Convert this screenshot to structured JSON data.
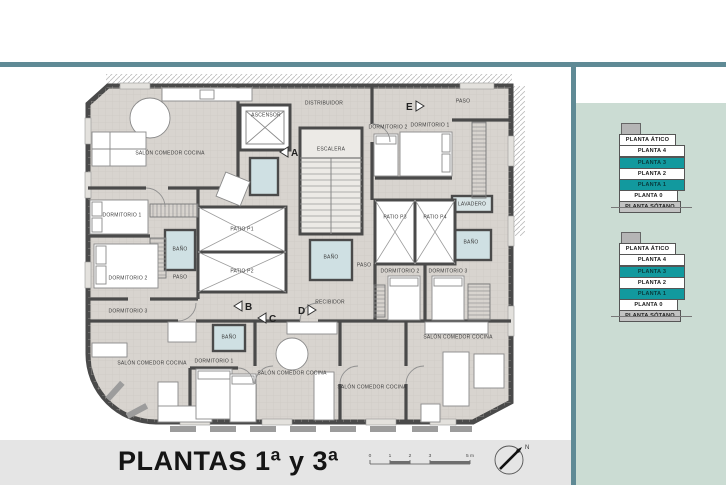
{
  "colors": {
    "frame": "#5f8a95",
    "panel_bg": "#cbdcd3",
    "highlight": "#12999e"
  },
  "title": "PLANTAS 1ª y 3ª",
  "legend": {
    "floors": [
      {
        "label": "PLANTA ÁTICO",
        "state": "plain"
      },
      {
        "label": "PLANTA 4",
        "state": "plain"
      },
      {
        "label": "PLANTA 3",
        "state": "teal"
      },
      {
        "label": "PLANTA 2",
        "state": "plain"
      },
      {
        "label": "PLANTA 1",
        "state": "teal"
      },
      {
        "label": "PLANTA 0",
        "state": "plain"
      },
      {
        "label": "PLANTA SÓTANO",
        "state": "gray"
      }
    ]
  },
  "plan": {
    "rooms": [
      {
        "label": "SALÓN COMEDOR COCINA"
      },
      {
        "label": "ASCENSOR"
      },
      {
        "label": "DISTRIBUIDOR"
      },
      {
        "label": "ESCALERA"
      },
      {
        "label": "PASO"
      },
      {
        "label": "DORMITORIO 1"
      },
      {
        "label": "DORMITORIO 2"
      },
      {
        "label": "LAVADERO"
      },
      {
        "label": "DORMITORIO 1"
      },
      {
        "label": "DORMITORIO 2"
      },
      {
        "label": "DORMITORIO 3"
      },
      {
        "label": "BAÑO"
      },
      {
        "label": "PASO"
      },
      {
        "label": "PATIO P1"
      },
      {
        "label": "PATIO P2"
      },
      {
        "label": "BAÑO"
      },
      {
        "label": "PASO"
      },
      {
        "label": "RECIBIDOR"
      },
      {
        "label": "PATIO P3"
      },
      {
        "label": "PATIO P4"
      },
      {
        "label": "BAÑO"
      },
      {
        "label": "DORMITORIO 2"
      },
      {
        "label": "DORMITORIO 3"
      },
      {
        "label": "SALÓN COMEDOR COCINA"
      },
      {
        "label": "BAÑO"
      },
      {
        "label": "DORMITORIO 1"
      },
      {
        "label": "SALÓN COMEDOR COCINA"
      },
      {
        "label": "SALÓN COMEDOR COCINA"
      },
      {
        "label": "SALÓN COMEDOR COCINA"
      }
    ],
    "section_markers": [
      {
        "letter": "A"
      },
      {
        "letter": "B"
      },
      {
        "letter": "C"
      },
      {
        "letter": "D"
      },
      {
        "letter": "E"
      }
    ]
  },
  "scalebar": {
    "labels": [
      "0",
      "1",
      "2",
      "3",
      "5 m"
    ]
  },
  "compass": {
    "label": "N"
  }
}
